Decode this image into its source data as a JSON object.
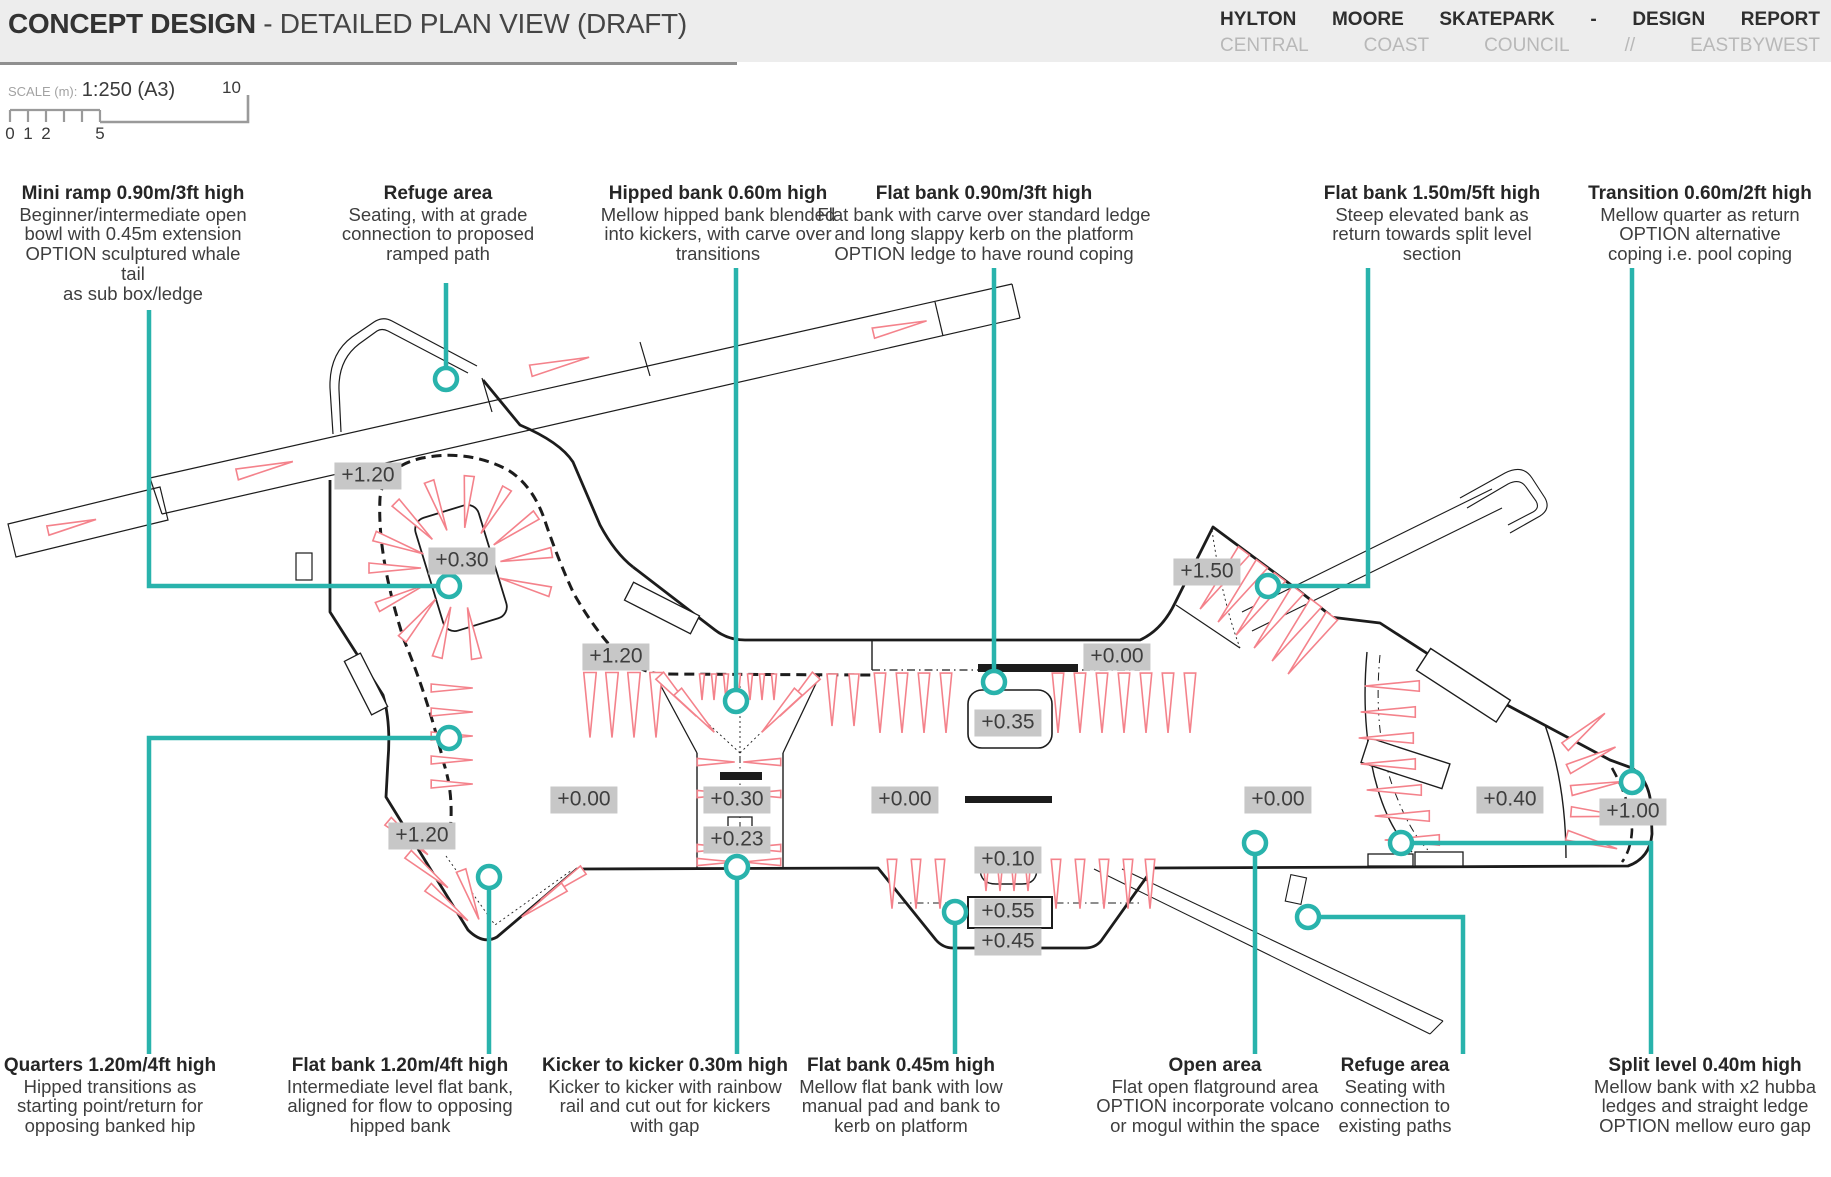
{
  "header": {
    "title_bold": "CONCEPT DESIGN",
    "title_rest": " - DETAILED PLAN VIEW (DRAFT)",
    "project_line1": [
      "HYLTON",
      "MOORE",
      "SKATEPARK",
      "-",
      "DESIGN",
      "REPORT"
    ],
    "project_line2": [
      "CENTRAL",
      "COAST",
      "COUNCIL",
      "//",
      "EASTBYWEST"
    ]
  },
  "scale": {
    "label": "SCALE (m):",
    "value": "1:250 (A3)",
    "tick_labels": [
      "0",
      "1",
      "2",
      "5"
    ],
    "end_label": "10"
  },
  "colors": {
    "accent_teal": "#29b3ac",
    "wedge_red": "#f4828b",
    "line_black": "#1c1c1c",
    "label_bg": "#c7c7c7"
  },
  "plan": {
    "level_labels": [
      {
        "text": "+1.20",
        "x": 368,
        "y": 476
      },
      {
        "text": "+0.30",
        "x": 462,
        "y": 561
      },
      {
        "text": "+1.20",
        "x": 616,
        "y": 657
      },
      {
        "text": "+1.50",
        "x": 1207,
        "y": 572
      },
      {
        "text": "+0.00",
        "x": 1117,
        "y": 657
      },
      {
        "text": "+0.35",
        "x": 1008,
        "y": 723
      },
      {
        "text": "+0.00",
        "x": 584,
        "y": 800
      },
      {
        "text": "+0.30",
        "x": 737,
        "y": 800
      },
      {
        "text": "+0.23",
        "x": 737,
        "y": 840
      },
      {
        "text": "+0.00",
        "x": 905,
        "y": 800
      },
      {
        "text": "+0.10",
        "x": 1008,
        "y": 860
      },
      {
        "text": "+0.55",
        "x": 1008,
        "y": 912
      },
      {
        "text": "+0.45",
        "x": 1008,
        "y": 942
      },
      {
        "text": "+0.00",
        "x": 1278,
        "y": 800
      },
      {
        "text": "+0.40",
        "x": 1510,
        "y": 800
      },
      {
        "text": "+1.00",
        "x": 1633,
        "y": 812
      },
      {
        "text": "+1.20",
        "x": 422,
        "y": 836
      }
    ]
  },
  "annotations": [
    {
      "id": "mini-ramp",
      "title": "Mini ramp 0.90m/3ft high",
      "body": "Beginner/intermediate open\nbowl with 0.45m extension\nOPTION sculptured whale tail\nas sub box/ledge",
      "cx": 133,
      "top": 184,
      "width": 240
    },
    {
      "id": "refuge-top",
      "title": "Refuge area",
      "body": "Seating, with at grade\nconnection to proposed\nramped path",
      "cx": 438,
      "top": 184,
      "width": 230
    },
    {
      "id": "hipped-bank",
      "title": "Hipped bank 0.60m high",
      "body": "Mellow hipped bank blended\ninto kickers, with carve over\ntransitions",
      "cx": 718,
      "top": 184,
      "width": 285
    },
    {
      "id": "flat-bank-090",
      "title": "Flat bank 0.90m/3ft high",
      "body": "Flat bank with carve over standard ledge\nand long slappy kerb on the platform\nOPTION ledge to have round coping",
      "cx": 984,
      "top": 184,
      "width": 370
    },
    {
      "id": "flat-bank-150",
      "title": "Flat bank 1.50m/5ft high",
      "body": "Steep elevated bank as\nreturn towards split level\nsection",
      "cx": 1432,
      "top": 184,
      "width": 250
    },
    {
      "id": "transition-060",
      "title": "Transition 0.60m/2ft high",
      "body": "Mellow quarter as return\nOPTION alternative\ncoping i.e. pool coping",
      "cx": 1700,
      "top": 184,
      "width": 250
    },
    {
      "id": "quarters",
      "title": "Quarters 1.20m/4ft high",
      "body": "Hipped transitions as\nstarting point/return for\nopposing banked hip",
      "cx": 110,
      "top": 1056,
      "width": 230
    },
    {
      "id": "flat-bank-120",
      "title": "Flat bank 1.20m/4ft high",
      "body": "Intermediate level flat bank,\naligned for flow to opposing\nhipped bank",
      "cx": 400,
      "top": 1056,
      "width": 300
    },
    {
      "id": "kicker",
      "title": "Kicker to kicker 0.30m high",
      "body": "Kicker to kicker with rainbow\nrail and cut out for kickers\nwith gap",
      "cx": 665,
      "top": 1056,
      "width": 285
    },
    {
      "id": "flat-bank-045",
      "title": "Flat bank 0.45m high",
      "body": "Mellow flat bank with low\nmanual pad and bank to\nkerb on platform",
      "cx": 901,
      "top": 1056,
      "width": 250
    },
    {
      "id": "open-area",
      "title": "Open area",
      "body": "Flat open flatground area\nOPTION incorporate volcano\nor mogul within the space",
      "cx": 1215,
      "top": 1056,
      "width": 280
    },
    {
      "id": "refuge-bottom",
      "title": "Refuge area",
      "body": "Seating with\nconnection to\nexisting paths",
      "cx": 1395,
      "top": 1056,
      "width": 165
    },
    {
      "id": "split-level",
      "title": "Split level 0.40m high",
      "body": "Mellow bank with x2 hubba\nledges and straight ledge\nOPTION mellow euro gap",
      "cx": 1705,
      "top": 1056,
      "width": 255
    }
  ]
}
